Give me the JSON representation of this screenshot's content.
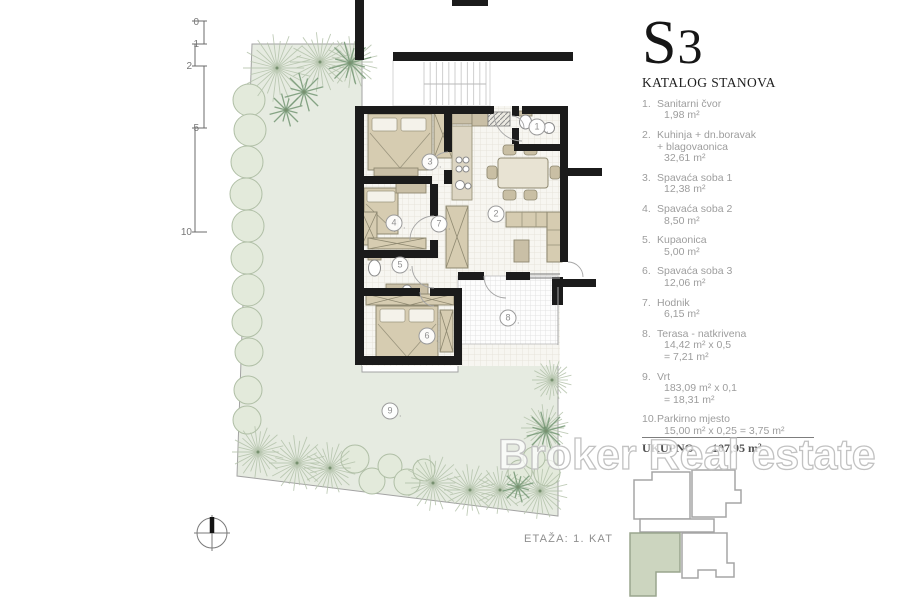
{
  "legend": {
    "code": "S3",
    "subtitle": "KATALOG STANOVA",
    "items": [
      {
        "no": "1.",
        "name_lines": [
          "Sanitarni čvor"
        ],
        "value_lines": [
          "1,98 m²"
        ]
      },
      {
        "no": "2.",
        "name_lines": [
          "Kuhinja + dn.boravak",
          "+ blagovaonica"
        ],
        "value_lines": [
          "32,61 m²"
        ]
      },
      {
        "no": "3.",
        "name_lines": [
          "Spavaća soba 1"
        ],
        "value_lines": [
          "12,38 m²"
        ]
      },
      {
        "no": "4.",
        "name_lines": [
          "Spavaća soba 2"
        ],
        "value_lines": [
          "8,50 m²"
        ]
      },
      {
        "no": "5.",
        "name_lines": [
          "Kupaonica"
        ],
        "value_lines": [
          "5,00 m²"
        ]
      },
      {
        "no": "6.",
        "name_lines": [
          "Spavaća soba 3"
        ],
        "value_lines": [
          "12,06 m²"
        ]
      },
      {
        "no": "7.",
        "name_lines": [
          "Hodnik"
        ],
        "value_lines": [
          "6,15 m²"
        ]
      },
      {
        "no": "8.",
        "name_lines": [
          "Terasa - natkrivena"
        ],
        "value_lines": [
          "14,42 m² x 0,5",
          "= 7,21 m²"
        ]
      },
      {
        "no": "9.",
        "name_lines": [
          "Vrt"
        ],
        "value_lines": [
          "183,09 m² x 0,1",
          "= 18,31 m²"
        ]
      },
      {
        "no": "10.",
        "name_lines": [
          "Parkirno mjesto"
        ],
        "value_lines": [
          "15,00 m² x 0,25 = 3,75 m²"
        ]
      }
    ],
    "total_label": "UKUPNO",
    "total_value": "107,95 m²"
  },
  "plan": {
    "floor_label": "ETAŽA: 1. KAT",
    "badge_dot": ".",
    "room_badges": [
      {
        "n": "1",
        "x": 537,
        "y": 127
      },
      {
        "n": "2",
        "x": 496,
        "y": 214
      },
      {
        "n": "3",
        "x": 430,
        "y": 162
      },
      {
        "n": "4",
        "x": 394,
        "y": 223
      },
      {
        "n": "5",
        "x": 400,
        "y": 265
      },
      {
        "n": "6",
        "x": 427,
        "y": 336
      },
      {
        "n": "7",
        "x": 439,
        "y": 224
      },
      {
        "n": "8",
        "x": 508,
        "y": 318
      },
      {
        "n": "9",
        "x": 390,
        "y": 411
      }
    ],
    "scale_ticks": [
      "0",
      "1",
      "2",
      "5",
      "10"
    ]
  },
  "watermark": "Broker Real estate",
  "colors": {
    "garden": "#e6ebe1",
    "wall": "#1b1b1b",
    "furniture": "#d6ccb1",
    "highlight": "#ccd5bf",
    "watermark": "#c2c2c2"
  }
}
